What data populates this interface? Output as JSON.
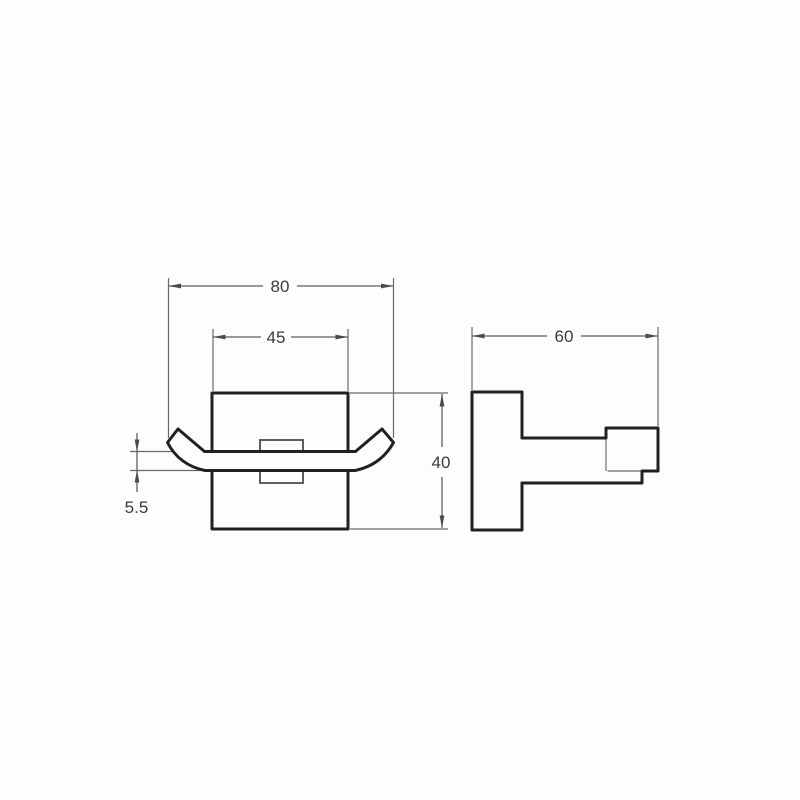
{
  "drawing": {
    "kind": "technical dimension drawing",
    "subject": "square double robe hook, front and side views"
  },
  "colors": {
    "background": "#fdfdfd",
    "outline": "#212121",
    "dimension_lines": "#5e5e5e",
    "hidden_lines": "#838383",
    "text": "#3a3a3a"
  },
  "front_view": {
    "overall_width": "80",
    "plate_width": "45",
    "plate_height": "40",
    "hook_thickness": "5.5"
  },
  "side_view": {
    "depth": "60"
  }
}
